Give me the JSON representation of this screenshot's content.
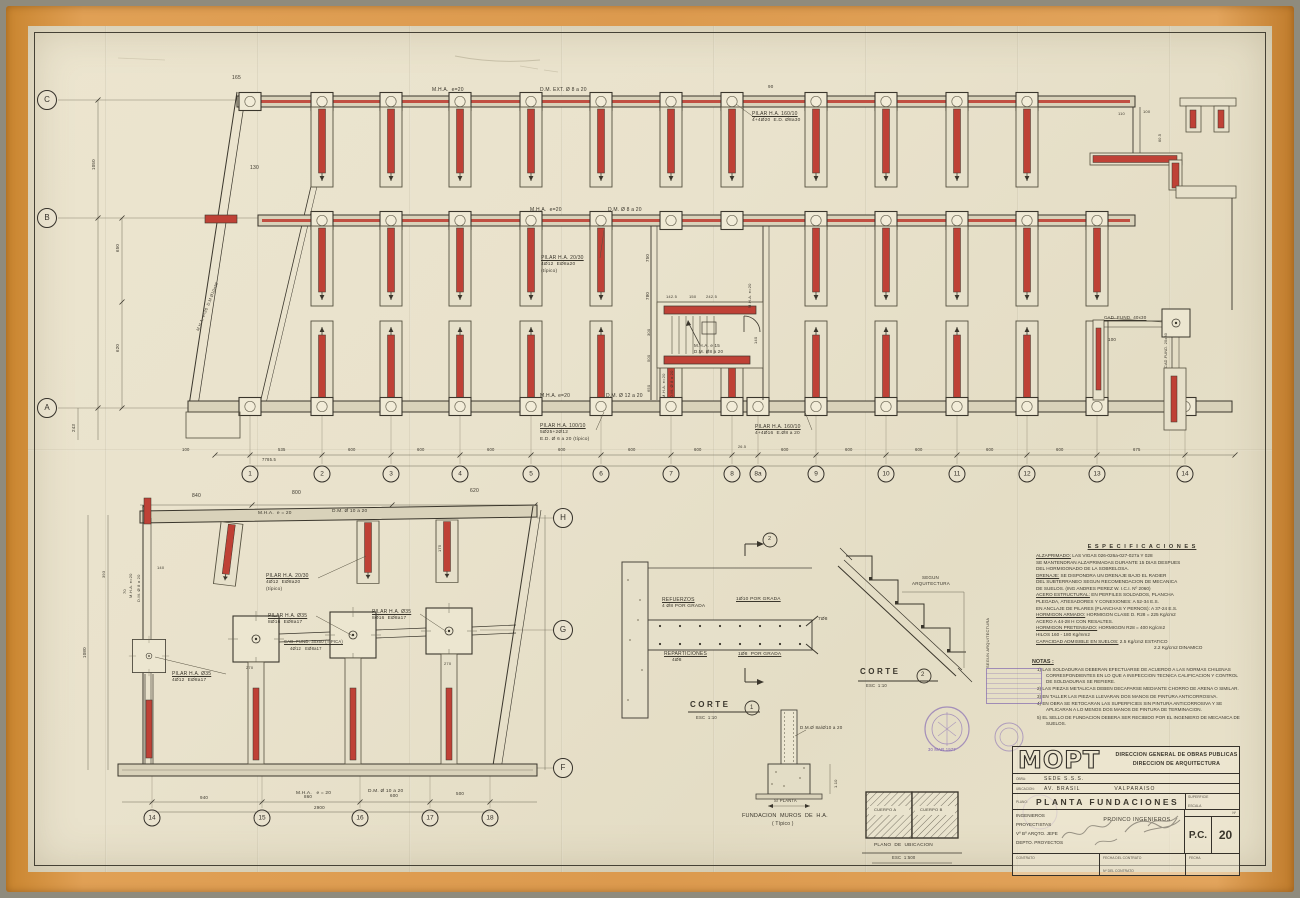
{
  "sheet": {
    "title": "PLANTA FUNDACIONES",
    "domain": "architectural foundation plan"
  },
  "colors": {
    "paper": "#e9e2cc",
    "tape": "#dc9a4e",
    "ink": "#3a362c",
    "red": "#bf4136",
    "stamp_purple": "#7a5fae"
  },
  "title_block": {
    "logo": "MOPT",
    "org1": "DIRECCION GENERAL DE OBRAS PUBLICAS",
    "org2": "DIRECCION   DE   ARQUITECTURA",
    "obra_label": "OBRA:",
    "obra": "SEDE  S.S.S.",
    "ubicacion_label": "UBICACION:",
    "ubicacion": "AV. BRASIL",
    "ciudad": "VALPARAISO",
    "plano_label": "PLANO:",
    "plano": "PLANTA  FUNDACIONES",
    "superficie": "SUPERFICIE",
    "escala": "ESCALA",
    "rol1": "INGENIEROS",
    "rol2": "PROYECTISTAS",
    "rol3": "Vº Bº ARQTO. JEFE",
    "rol4": "DEPTO. PROYECTOS",
    "proinco": "PROINCO  INGENIEROS",
    "num_label": "Nº",
    "pc": "P.C.",
    "numero": "20",
    "contrato": "CONTRATO",
    "fecha_contrato": "FECHA DEL CONTRATO",
    "n_contrato": "Nº  DEL CONTRATO",
    "fecha": "FECHA"
  },
  "stamp": {
    "date": "30 MAR 1977"
  },
  "specs": {
    "title": "E S P E C I F I C A C I O N E S",
    "lines": [
      {
        "lead": "ALZAPRIMADO:",
        "rest": "LAS VIGAS 026-026a-027-027a Y 028"
      },
      {
        "rest": "SE MANTENDRAN ALZAPRIMADAS DURANTE 15 DIAS DESPUES"
      },
      {
        "rest": "DEL HORMIGONADO DE LA SOBRELOSA."
      },
      {
        "lead": "DRENAJE:",
        "rest": "SE DISPONDRA UN DRENAJE BAJO EL RADIER"
      },
      {
        "rest": "DEL SUBTERRANEO SEGUN RECOMENDACION DE MECANICA"
      },
      {
        "rest": "DE SUELOS. (ING ANDRES PEREZ W.   I.C.I. Nº 2060)"
      },
      {
        "lead": "ACERO ESTRUCTURAL:",
        "rest": "EN PERFILES SOLDADOS, PLANCHA"
      },
      {
        "rest": "PLEGADA, ATIESADORES Y CONEXIONES: A 52-34 E.S."
      },
      {
        "rest": "EN ANCLAJE DE PILARES (PLANCHAS Y PERNOS): A 37-24 E.S."
      },
      {
        "lead": "HORMIGON ARMADO:",
        "rest": "HORMIGON CLASE D.  R28 = 225 Kg/cm2"
      },
      {
        "rest": "ACERO A 44-28 H CON RESALTES."
      },
      {
        "lead": "HORMIGON PRETENSADO:",
        "rest": "HORMIGON  R28 = 400 Kg/cm2"
      },
      {
        "rest": "HILOS  160 - 180  Kg/mm2"
      },
      {
        "lead": "CAPACIDAD ADMISIBLE EN SUELOS:",
        "rest": "2.5 Kg/cm2 ESTATICO"
      },
      {
        "rest": "2.2 Kg/cm2 DINAMICO",
        "ind": 118
      }
    ]
  },
  "notas": {
    "title": "NOTAS :",
    "items": [
      "1) LAS SOLDADURAS DEBERAN EFECTUARSE DE ACUERDO A LAS NORMAS CHILENAS CORRESPONDIENTES EN LO QUE A INSPECCION TECNICA CALIFICACION Y CONTROL DE SOLDADURAS SE REFIERE.",
      "2) LAS PIEZAS METALICAS DEBEN DECAPARSE MEDIANTE CHORRO DE ARENA O SIMILAR.",
      "3) EN TALLER LAS PIEZAS LLEVARAN DOS MANOS DE PINTURA ANTICORROSIVA.",
      "4) EN OBRA SE RETOCARAN LAS SUPERFICIES SIN PINTURA ANTICORROSIVA Y SE APLICARAN A LO MENOS DOS MANOS DE PINTURA DE TERMINACION.",
      "5) EL SELLO DE FUNDACION DEBERA SER RECIBIDO POR EL INGENIERO DE MECANICA DE SUELOS."
    ]
  },
  "grid": {
    "upper_letters": [
      {
        "t": "C",
        "x": 47,
        "y": 100
      },
      {
        "t": "B",
        "x": 47,
        "y": 218
      },
      {
        "t": "A",
        "x": 47,
        "y": 408
      }
    ],
    "upper_numbers_y": 474,
    "upper_numbers": [
      {
        "t": "1",
        "x": 250
      },
      {
        "t": "2",
        "x": 322
      },
      {
        "t": "3",
        "x": 391
      },
      {
        "t": "4",
        "x": 460
      },
      {
        "t": "5",
        "x": 531
      },
      {
        "t": "6",
        "x": 601
      },
      {
        "t": "7",
        "x": 671
      },
      {
        "t": "8",
        "x": 732
      },
      {
        "t": "8a",
        "x": 758
      },
      {
        "t": "9",
        "x": 816
      },
      {
        "t": "10",
        "x": 886
      },
      {
        "t": "11",
        "x": 957
      },
      {
        "t": "12",
        "x": 1027
      },
      {
        "t": "13",
        "x": 1097
      },
      {
        "t": "14",
        "x": 1185
      }
    ],
    "lower_letters": [
      {
        "t": "H",
        "x": 563,
        "y": 518
      },
      {
        "t": "G",
        "x": 563,
        "y": 630
      },
      {
        "t": "F",
        "x": 563,
        "y": 768
      }
    ],
    "lower_numbers_y": 818,
    "lower_numbers": [
      {
        "t": "14",
        "x": 152
      },
      {
        "t": "15",
        "x": 262
      },
      {
        "t": "16",
        "x": 360
      },
      {
        "t": "17",
        "x": 430
      },
      {
        "t": "18",
        "x": 490
      }
    ]
  },
  "annotations": [
    {
      "t": "165",
      "x": 232,
      "y": 76,
      "fs": 5
    },
    {
      "t": "130",
      "x": 250,
      "y": 166,
      "fs": 5
    },
    {
      "t": "M.H.A.  e=20",
      "x": 432,
      "y": 88,
      "fs": 5
    },
    {
      "t": "D.M. EXT. Ø 8 a 20",
      "x": 540,
      "y": 88,
      "fs": 5
    },
    {
      "t": "90",
      "x": 768,
      "y": 85,
      "fs": 4.5
    },
    {
      "t": "PILAR H.A. 160/10",
      "x": 752,
      "y": 112,
      "fs": 5,
      "u": 1
    },
    {
      "t": "4+4Ø20  E.D. Ø8a30",
      "x": 752,
      "y": 119,
      "fs": 4.8
    },
    {
      "t": "M.H.A.  e=20",
      "x": 530,
      "y": 208,
      "fs": 5
    },
    {
      "t": "D.M. Ø 8 a 20",
      "x": 608,
      "y": 208,
      "fs": 5
    },
    {
      "t": "PILAR H.A. 20/30",
      "x": 541,
      "y": 256,
      "fs": 5,
      "u": 1
    },
    {
      "t": "4Ø12  EØ8a20",
      "x": 541,
      "y": 263,
      "fs": 4.8
    },
    {
      "t": "(típico)",
      "x": 541,
      "y": 270,
      "fs": 4.8
    },
    {
      "t": "750",
      "x": 646,
      "y": 262,
      "fs": 4.5,
      "r": -90
    },
    {
      "t": "780",
      "x": 646,
      "y": 300,
      "fs": 4.5,
      "r": -90
    },
    {
      "t": "142.5",
      "x": 666,
      "y": 295,
      "fs": 4
    },
    {
      "t": "150",
      "x": 689,
      "y": 295,
      "fs": 4
    },
    {
      "t": "242.5",
      "x": 706,
      "y": 295,
      "fs": 4
    },
    {
      "t": "M.H.A. e 15",
      "x": 694,
      "y": 344,
      "fs": 4.5
    },
    {
      "t": "D.M. Ø8 a 20",
      "x": 694,
      "y": 350,
      "fs": 4.5
    },
    {
      "t": "M.H.A. e=20",
      "x": 748,
      "y": 308,
      "fs": 4,
      "r": -90
    },
    {
      "t": "300",
      "x": 647,
      "y": 336,
      "fs": 4,
      "r": -90
    },
    {
      "t": "500",
      "x": 647,
      "y": 362,
      "fs": 4,
      "r": -90
    },
    {
      "t": "650",
      "x": 647,
      "y": 392,
      "fs": 4,
      "r": -90
    },
    {
      "t": "140",
      "x": 754,
      "y": 344,
      "fs": 4,
      "r": -90
    },
    {
      "t": "M.H.A. e=20",
      "x": 662,
      "y": 398,
      "fs": 4,
      "r": -90
    },
    {
      "t": "D.M. Ø 8 a 20",
      "x": 670,
      "y": 398,
      "fs": 4,
      "r": -90
    },
    {
      "t": "M.H.A. e=20",
      "x": 540,
      "y": 394,
      "fs": 5
    },
    {
      "t": "D.M. Ø 12 a 20",
      "x": 606,
      "y": 394,
      "fs": 5
    },
    {
      "t": "PILAR H.A. 100/10",
      "x": 540,
      "y": 424,
      "fs": 5,
      "u": 1
    },
    {
      "t": "5Ø25+2Ø12",
      "x": 540,
      "y": 431,
      "fs": 4.8
    },
    {
      "t": "E.D. Ø 6 a 20 (típico)",
      "x": 540,
      "y": 438,
      "fs": 4.8
    },
    {
      "t": "PILAR H.A. 160/10",
      "x": 755,
      "y": 425,
      "fs": 5,
      "u": 1
    },
    {
      "t": "4+4Ø16  E.Ø8 a 20",
      "x": 755,
      "y": 432,
      "fs": 4.8
    },
    {
      "t": "M.H.A. e=20  D.M.Ø10a20",
      "x": 196,
      "y": 330,
      "fs": 4,
      "r": -68
    },
    {
      "t": "1050",
      "x": 92,
      "y": 170,
      "fs": 4.5,
      "r": -90
    },
    {
      "t": "650",
      "x": 116,
      "y": 252,
      "fs": 4.5,
      "r": -90
    },
    {
      "t": "620",
      "x": 116,
      "y": 352,
      "fs": 4.5,
      "r": -90
    },
    {
      "t": "243",
      "x": 72,
      "y": 432,
      "fs": 4.5,
      "r": -90
    },
    {
      "t": "100",
      "x": 182,
      "y": 448,
      "fs": 4.2
    },
    {
      "t": "535",
      "x": 278,
      "y": 448,
      "fs": 4.2
    },
    {
      "t": "600",
      "x": 348,
      "y": 448,
      "fs": 4.2
    },
    {
      "t": "600",
      "x": 417,
      "y": 448,
      "fs": 4.2
    },
    {
      "t": "600",
      "x": 487,
      "y": 448,
      "fs": 4.2
    },
    {
      "t": "600",
      "x": 558,
      "y": 448,
      "fs": 4.2
    },
    {
      "t": "600",
      "x": 628,
      "y": 448,
      "fs": 4.2
    },
    {
      "t": "600",
      "x": 694,
      "y": 448,
      "fs": 4.2
    },
    {
      "t": "26.5",
      "x": 738,
      "y": 446,
      "fs": 3.8
    },
    {
      "t": "600",
      "x": 781,
      "y": 448,
      "fs": 4.2
    },
    {
      "t": "600",
      "x": 845,
      "y": 448,
      "fs": 4.2
    },
    {
      "t": "600",
      "x": 915,
      "y": 448,
      "fs": 4.2
    },
    {
      "t": "600",
      "x": 986,
      "y": 448,
      "fs": 4.2
    },
    {
      "t": "600",
      "x": 1056,
      "y": 448,
      "fs": 4.2
    },
    {
      "t": "675",
      "x": 1133,
      "y": 448,
      "fs": 4.2
    },
    {
      "t": "7785.5",
      "x": 262,
      "y": 458,
      "fs": 4.2
    },
    {
      "t": "110",
      "x": 1118,
      "y": 112,
      "fs": 4
    },
    {
      "t": "100",
      "x": 1143,
      "y": 110,
      "fs": 4
    },
    {
      "t": "60.5",
      "x": 1159,
      "y": 142,
      "fs": 3.8,
      "r": -90
    },
    {
      "t": "CAD. FUND. 40x30",
      "x": 1104,
      "y": 316,
      "fs": 4.5,
      "u": 1
    },
    {
      "t": "100",
      "x": 1108,
      "y": 338,
      "fs": 4.5
    },
    {
      "t": "CAD.FUND. 20x30",
      "x": 1165,
      "y": 368,
      "fs": 3.8,
      "r": -90
    },
    {
      "t": "840",
      "x": 192,
      "y": 494,
      "fs": 5
    },
    {
      "t": "800",
      "x": 292,
      "y": 491,
      "fs": 5
    },
    {
      "t": "620",
      "x": 470,
      "y": 489,
      "fs": 5
    },
    {
      "t": "M.H.A.  e = 20",
      "x": 258,
      "y": 512,
      "fs": 4.8
    },
    {
      "t": "D.M. Ø 10 a 20",
      "x": 332,
      "y": 510,
      "fs": 4.8
    },
    {
      "t": "175",
      "x": 438,
      "y": 552,
      "fs": 4,
      "r": -90
    },
    {
      "t": "PILAR H.A. 20/30",
      "x": 266,
      "y": 574,
      "fs": 5,
      "u": 1
    },
    {
      "t": "4Ø12  EØ8a20",
      "x": 266,
      "y": 581,
      "fs": 4.8
    },
    {
      "t": "(típico)",
      "x": 266,
      "y": 588,
      "fs": 4.8
    },
    {
      "t": "M.H.A. e=20",
      "x": 129,
      "y": 598,
      "fs": 4,
      "r": -90
    },
    {
      "t": "D.M. Ø 8 a 20",
      "x": 137,
      "y": 602,
      "fs": 4,
      "r": -90
    },
    {
      "t": "393",
      "x": 102,
      "y": 578,
      "fs": 4,
      "r": -90
    },
    {
      "t": "140",
      "x": 157,
      "y": 566,
      "fs": 4
    },
    {
      "t": "70",
      "x": 123,
      "y": 594,
      "fs": 4,
      "r": -90
    },
    {
      "t": "1080",
      "x": 83,
      "y": 658,
      "fs": 4.5,
      "r": -90
    },
    {
      "t": "PILAR H.A. Ø35",
      "x": 268,
      "y": 614,
      "fs": 5,
      "u": 1
    },
    {
      "t": "8Ø16  EØ8a17",
      "x": 268,
      "y": 621,
      "fs": 4.8
    },
    {
      "t": "PILAR H.A. Ø35",
      "x": 372,
      "y": 610,
      "fs": 5,
      "u": 1
    },
    {
      "t": "8Ø16  EØ8a17",
      "x": 372,
      "y": 617,
      "fs": 4.8
    },
    {
      "t": "CAD. FUND. 30x60 (TIPICA)",
      "x": 284,
      "y": 640,
      "fs": 4.2,
      "u": 1
    },
    {
      "t": "4Ø12   EØ8a17",
      "x": 290,
      "y": 647,
      "fs": 4.2
    },
    {
      "t": "PILAR H.A. Ø35",
      "x": 172,
      "y": 672,
      "fs": 5,
      "u": 1
    },
    {
      "t": "4Ø12  EØ8a17",
      "x": 172,
      "y": 679,
      "fs": 4.8
    },
    {
      "t": "270",
      "x": 246,
      "y": 666,
      "fs": 4
    },
    {
      "t": "270",
      "x": 444,
      "y": 662,
      "fs": 4
    },
    {
      "t": "M.H.A.   e = 20",
      "x": 296,
      "y": 792,
      "fs": 4.8
    },
    {
      "t": "D.M. Ø 10 a 20",
      "x": 368,
      "y": 790,
      "fs": 4.8
    },
    {
      "t": "940",
      "x": 200,
      "y": 796,
      "fs": 4.5
    },
    {
      "t": "860",
      "x": 304,
      "y": 795,
      "fs": 4.5
    },
    {
      "t": "600",
      "x": 390,
      "y": 794,
      "fs": 4.5
    },
    {
      "t": "500",
      "x": 456,
      "y": 792,
      "fs": 4.5
    },
    {
      "t": "2900",
      "x": 314,
      "y": 806,
      "fs": 4.5
    },
    {
      "t": "REFUERZOS",
      "x": 662,
      "y": 598,
      "fs": 5,
      "u": 1
    },
    {
      "t": "4 Ø8 POR GRADA",
      "x": 662,
      "y": 605,
      "fs": 4.8
    },
    {
      "t": "1Ø10 POR GRADA",
      "x": 736,
      "y": 598,
      "fs": 4.8,
      "u": 1
    },
    {
      "t": "7Ø8",
      "x": 818,
      "y": 618,
      "fs": 4.8
    },
    {
      "t": "REPARTICIONES",
      "x": 664,
      "y": 652,
      "fs": 5,
      "u": 1
    },
    {
      "t": "4Ø8",
      "x": 672,
      "y": 659,
      "fs": 4.8
    },
    {
      "t": "1Ø8  POR GRADA",
      "x": 738,
      "y": 653,
      "fs": 4.8,
      "u": 1
    },
    {
      "t": "CORTE",
      "x": 690,
      "y": 701,
      "fs": 8,
      "b": 1,
      "ls": 2.5
    },
    {
      "t": "1",
      "x": 750,
      "y": 705,
      "fs": 6
    },
    {
      "t": "ESC  1:10",
      "x": 696,
      "y": 716,
      "fs": 4.2
    },
    {
      "t": "2",
      "x": 768,
      "y": 537,
      "fs": 5.5
    },
    {
      "t": "SEGUN",
      "x": 922,
      "y": 576,
      "fs": 4.5
    },
    {
      "t": "ARQUITECTURA",
      "x": 912,
      "y": 582,
      "fs": 4.5
    },
    {
      "t": "SEGUN ARQUITECTURA",
      "x": 986,
      "y": 668,
      "fs": 4,
      "r": -90
    },
    {
      "t": "CORTE",
      "x": 860,
      "y": 668,
      "fs": 8,
      "b": 1,
      "ls": 2.5
    },
    {
      "t": "2",
      "x": 921,
      "y": 672,
      "fs": 6
    },
    {
      "t": "ESC  1:10",
      "x": 866,
      "y": 684,
      "fs": 4.2
    },
    {
      "t": "D.M.Ø 8a/Ø10 a 20",
      "x": 800,
      "y": 726,
      "fs": 4.5
    },
    {
      "t": "1.10",
      "x": 834,
      "y": 788,
      "fs": 4,
      "r": -90
    },
    {
      "t": "S/ PLANTA",
      "x": 774,
      "y": 799,
      "fs": 4.2
    },
    {
      "t": "FUNDACION  MUROS  DE  H.A.",
      "x": 742,
      "y": 814,
      "fs": 5.5
    },
    {
      "t": "( Típico )",
      "x": 772,
      "y": 822,
      "fs": 5
    },
    {
      "t": "CUERPO A",
      "x": 874,
      "y": 808,
      "fs": 4
    },
    {
      "t": "CUERPO B",
      "x": 920,
      "y": 808,
      "fs": 4
    },
    {
      "t": "PLANO  DE  UBICACION",
      "x": 874,
      "y": 844,
      "fs": 4.8
    },
    {
      "t": "ESC  1:500",
      "x": 892,
      "y": 856,
      "fs": 4.2
    },
    {
      "t": "30 MAR 1977",
      "x": 928,
      "y": 748,
      "fs": 4.2,
      "c": "purple"
    }
  ]
}
